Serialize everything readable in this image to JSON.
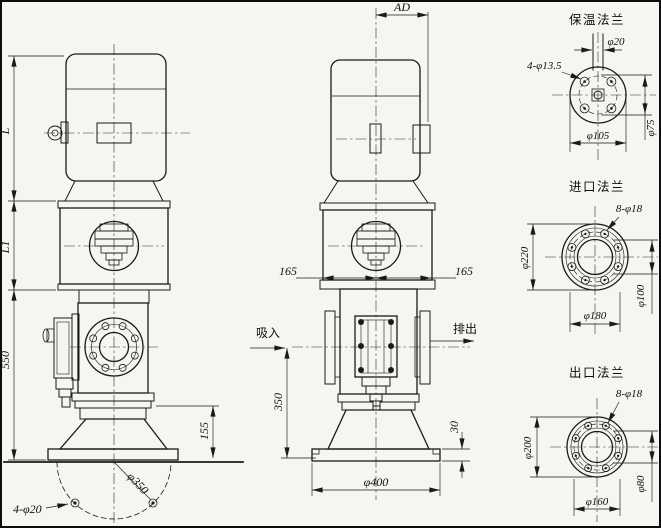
{
  "front": {
    "dim_l": "L",
    "dim_l1": "L1",
    "dim_550": "550",
    "dim_155": "155",
    "dim_anchor_holes": "4-φ20",
    "dim_anchor_circle": "φ350"
  },
  "side": {
    "dim_ad": "AD",
    "dim_165_left": "165",
    "dim_165_right": "165",
    "suction": "吸入",
    "discharge": "排出",
    "dim_350": "350",
    "dim_30": "30",
    "dim_400": "φ400"
  },
  "flanges": [
    {
      "title": "保温法兰",
      "pipe": "φ20",
      "holes": "4-φ13.5",
      "outer": "φ105",
      "bolt_circle": "φ75"
    },
    {
      "title": "进口法兰",
      "holes": "8-φ18",
      "outer": "φ220",
      "bolt_circle": "φ180",
      "bore": "φ100"
    },
    {
      "title": "出口法兰",
      "holes": "8-φ18",
      "outer": "φ200",
      "bolt_circle": "φ160",
      "bore": "φ80"
    }
  ]
}
